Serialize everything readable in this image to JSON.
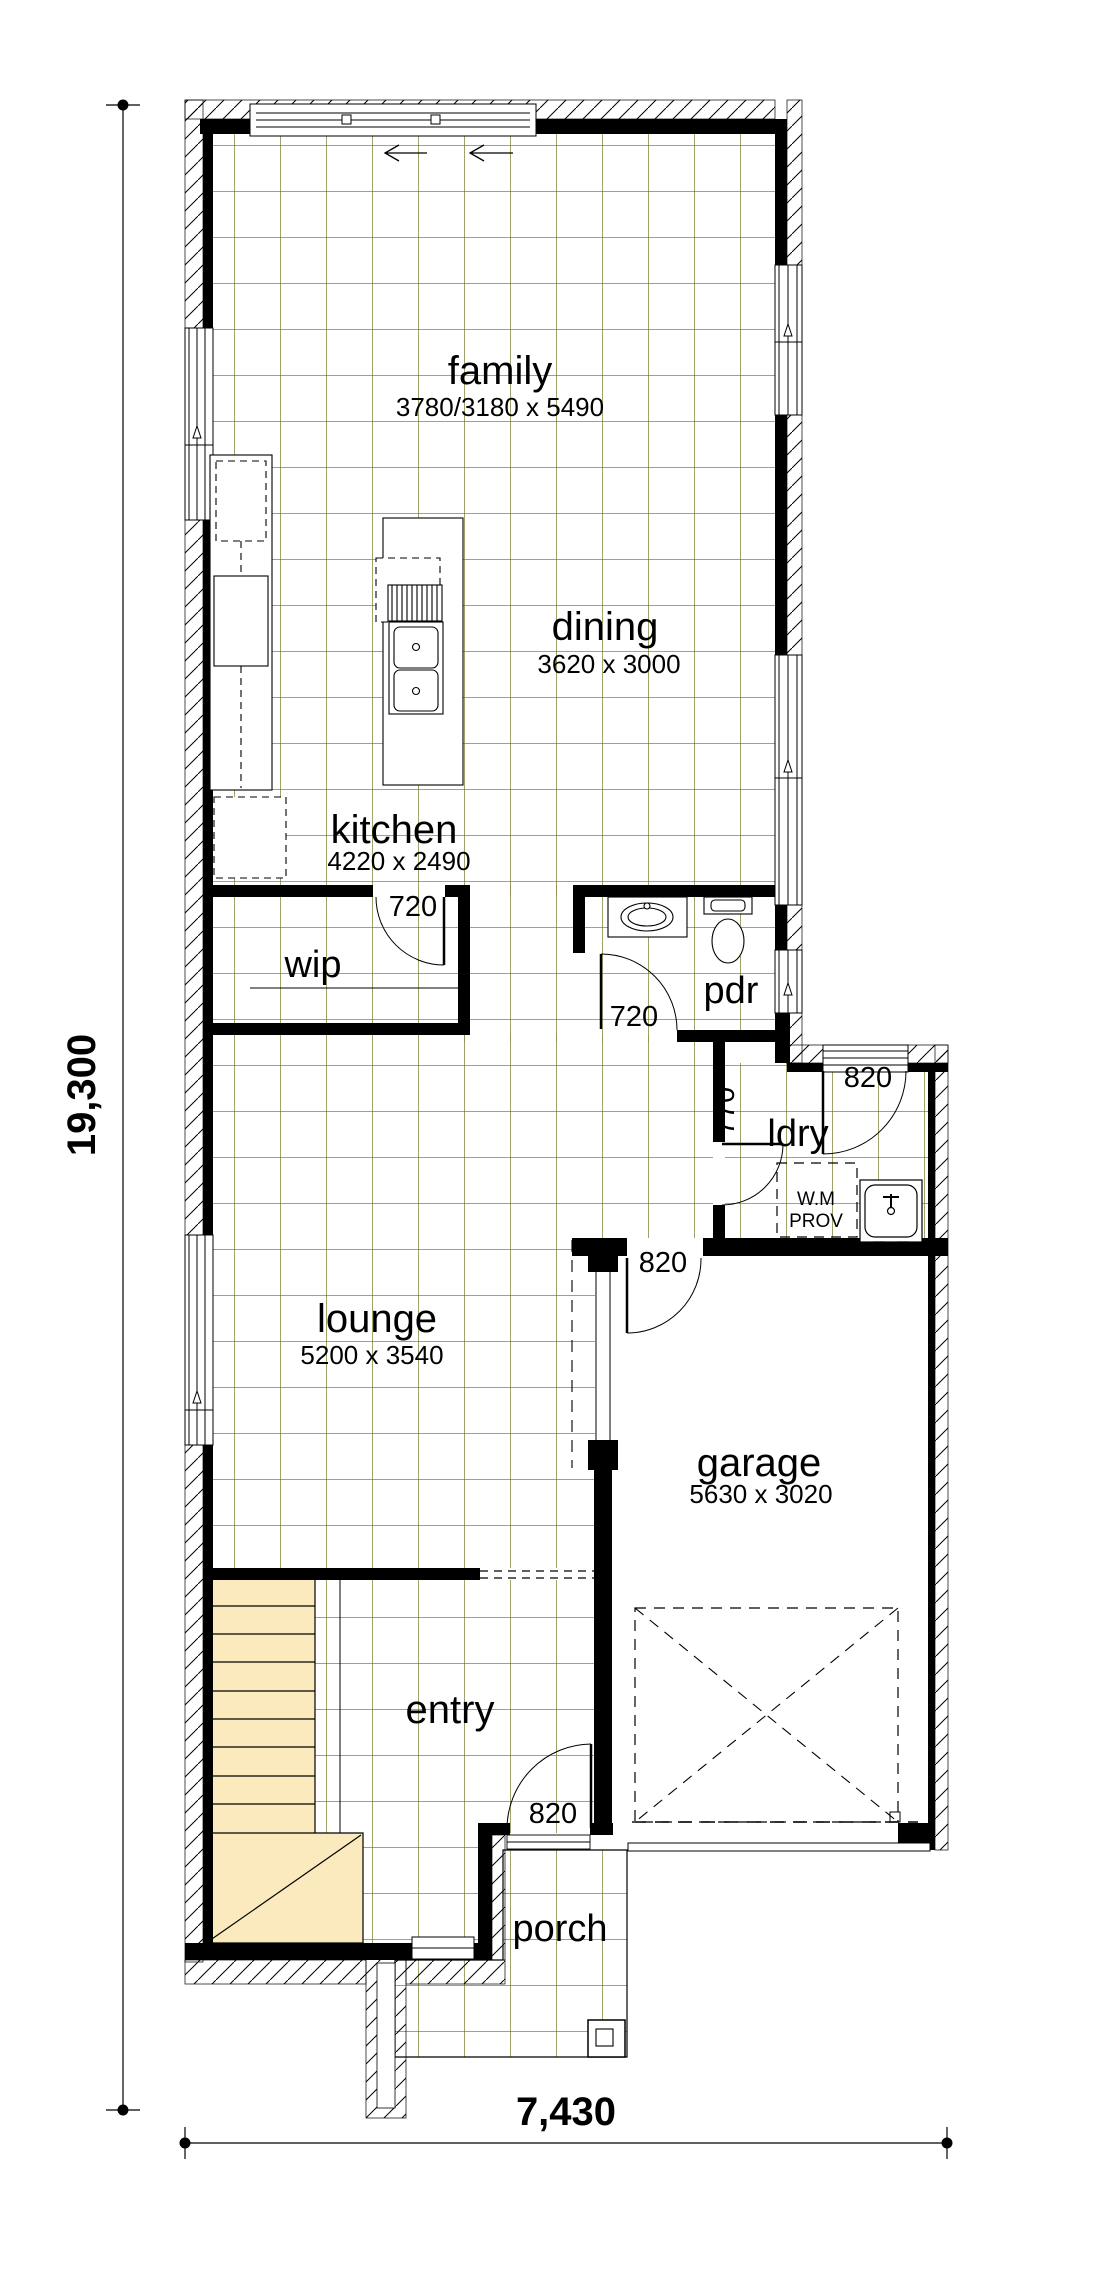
{
  "drawing": {
    "type": "floor-plan",
    "rooms": {
      "family": {
        "label": "family",
        "size": "3780/3180 x 5490"
      },
      "dining": {
        "label": "dining",
        "size": "3620 x 3000"
      },
      "kitchen": {
        "label": "kitchen",
        "size": "4220 x 2490"
      },
      "wip": {
        "label": "wip"
      },
      "pdr": {
        "label": "pdr"
      },
      "ldry": {
        "label": "ldry"
      },
      "lounge": {
        "label": "lounge",
        "size": "5200 x 3540"
      },
      "garage": {
        "label": "garage",
        "size": "5630 x 3020"
      },
      "entry": {
        "label": "entry"
      },
      "porch": {
        "label": "porch"
      }
    },
    "doors": {
      "kitchen_hall": "720",
      "pdr": "720",
      "ldry_internal": "770",
      "ldry_external": "820",
      "garage_internal": "820",
      "front": "820"
    },
    "annotations": {
      "wm_prov_line1": "W.M",
      "wm_prov_line2": "PROV"
    },
    "dimensions": {
      "overall_depth": "19,300",
      "overall_width": "7,430"
    },
    "colors": {
      "tile_grid": "#6e6e1a",
      "stair_fill": "#faeabd",
      "wall": "#000000"
    }
  }
}
